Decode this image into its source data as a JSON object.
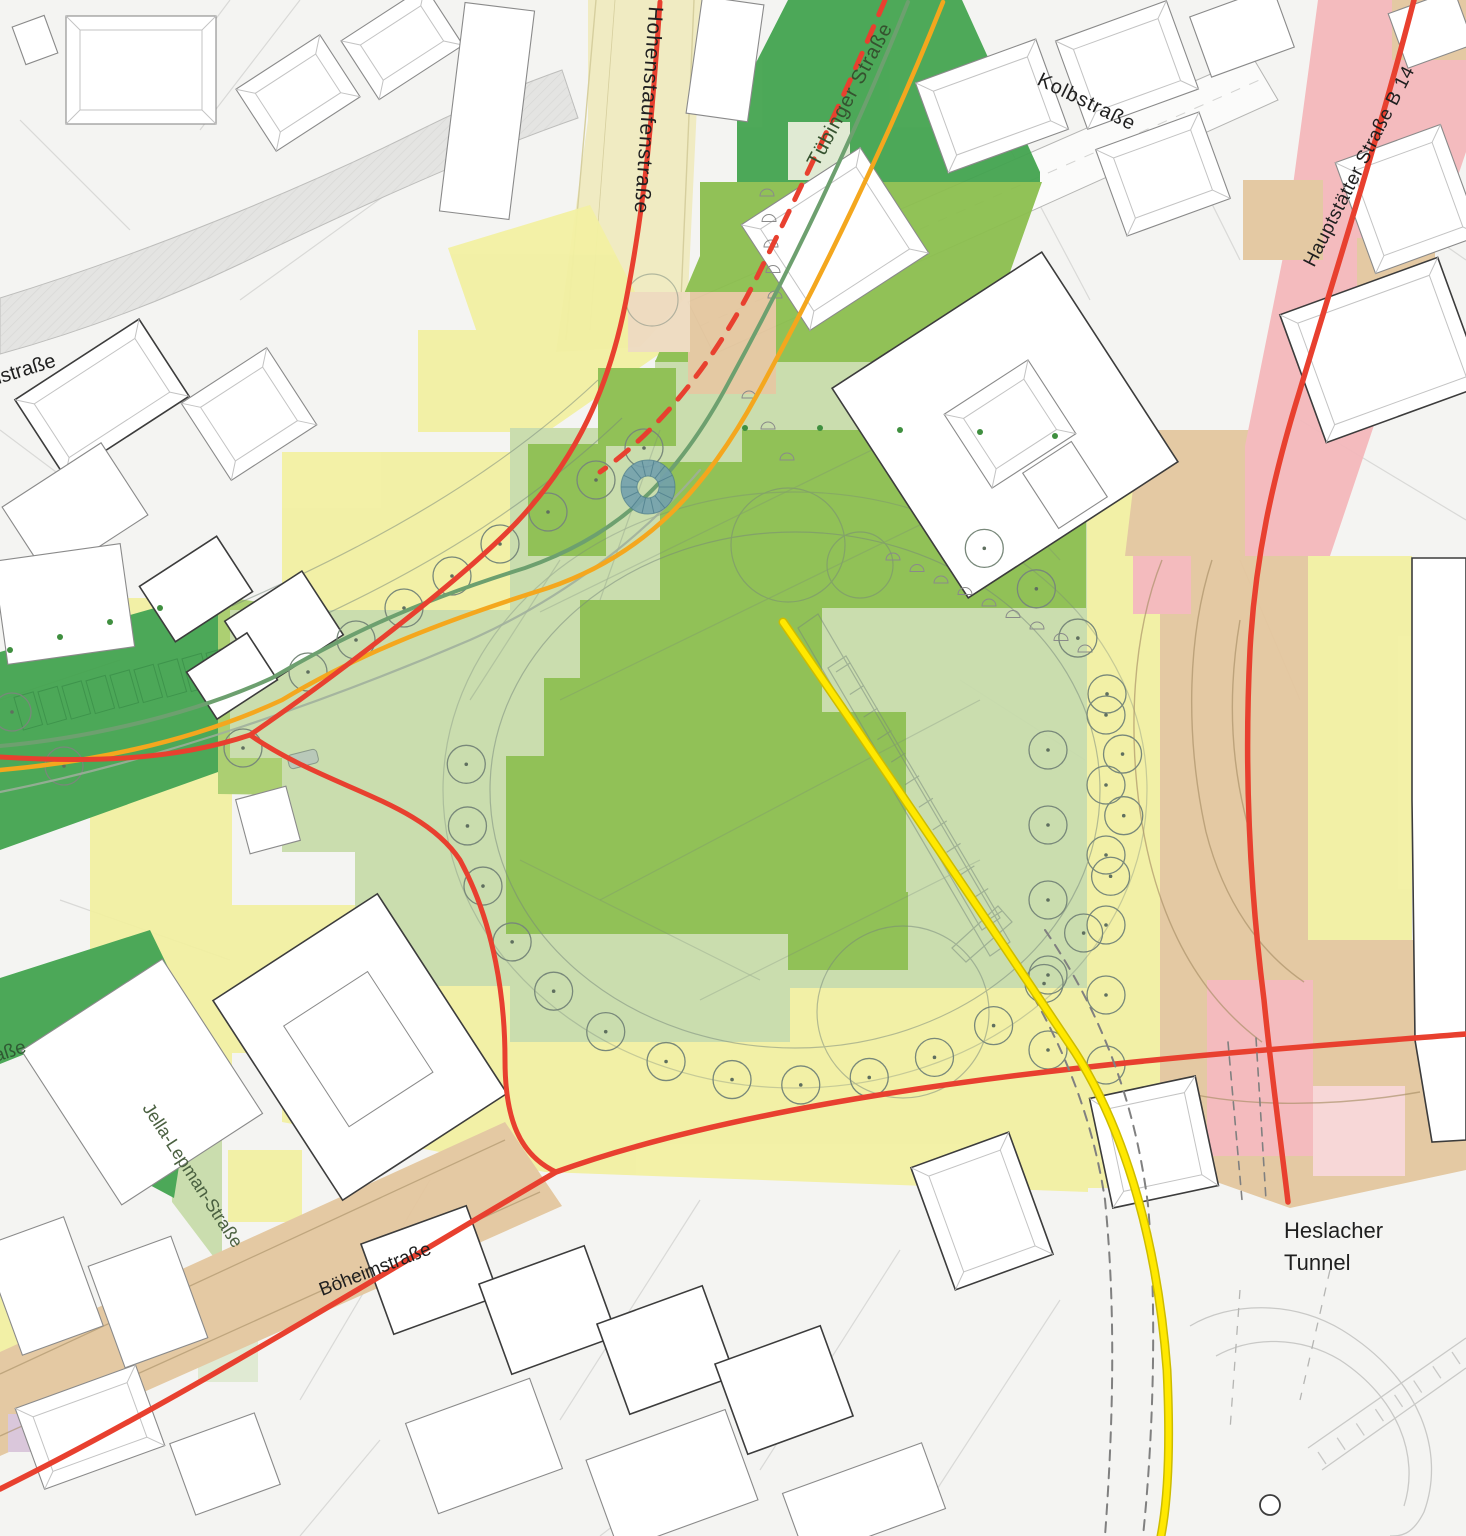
{
  "map": {
    "type_hint": "urban planning quality heat-map over cadastral site plan"
  },
  "labels": {
    "hohenstaufen": "Hohenstaufenstraße",
    "tuebinger": "Tübinger Straße",
    "kolb": "Kolbstraße",
    "hauptstaetter": "Hauptstätter Straße B 14",
    "jella": "Jella-Lepman-Straße",
    "boeheim": "Böheimstraße",
    "heslacher_line1": "Heslacher",
    "heslacher_line2": "Tunnel",
    "fragment_top_left": "nstraße",
    "fragment_left": "aße"
  },
  "colors": {
    "background": "#f4f4f2",
    "parcel_line": "#d9d9d7",
    "building_fill": "#ffffff",
    "building_stroke": "#8a8a8a",
    "building_stroke_dark": "#3c3c3c",
    "ridge_line": "#c3c3c3",
    "road_pale": "#f0ebc2",
    "road_pale_edge": "#d6cf9e",
    "road_gray": "#e4e4e2",
    "road_white": "#fbfbfa",
    "heat_dark_green": "#44a450",
    "heat_green": "#8cbf4f",
    "heat_green_bright": "#a9ce6c",
    "heat_light_green": "#c8dcab",
    "heat_pale_green": "#dfead2",
    "heat_yellow": "#f2f0a2",
    "heat_tan": "#e4c79f",
    "heat_tan_light": "#eedbc0",
    "heat_pink": "#f4b9bc",
    "heat_pink_light": "#f8d6d6",
    "heat_lavender": "#d9c5da",
    "route_red": "#e8402f",
    "route_orange": "#f4a71e",
    "route_green": "#6da06f",
    "route_yellow": "#ffe800",
    "route_yellow_edge": "#cdbc00",
    "track_gray": "#808080",
    "sketch_line": "#75857a",
    "loop_line": "#a88f66",
    "fountain_blue": "#72a0ad",
    "fountain_spoke": "#4e7e8c",
    "tree_stroke": "#78887a",
    "tree_dot": "#5f6f5f",
    "small_tree": "#3f8f3f",
    "label_dark": "#1f1f1f",
    "label_green_dark": "#35522f",
    "label_olive": "#4a6040"
  }
}
